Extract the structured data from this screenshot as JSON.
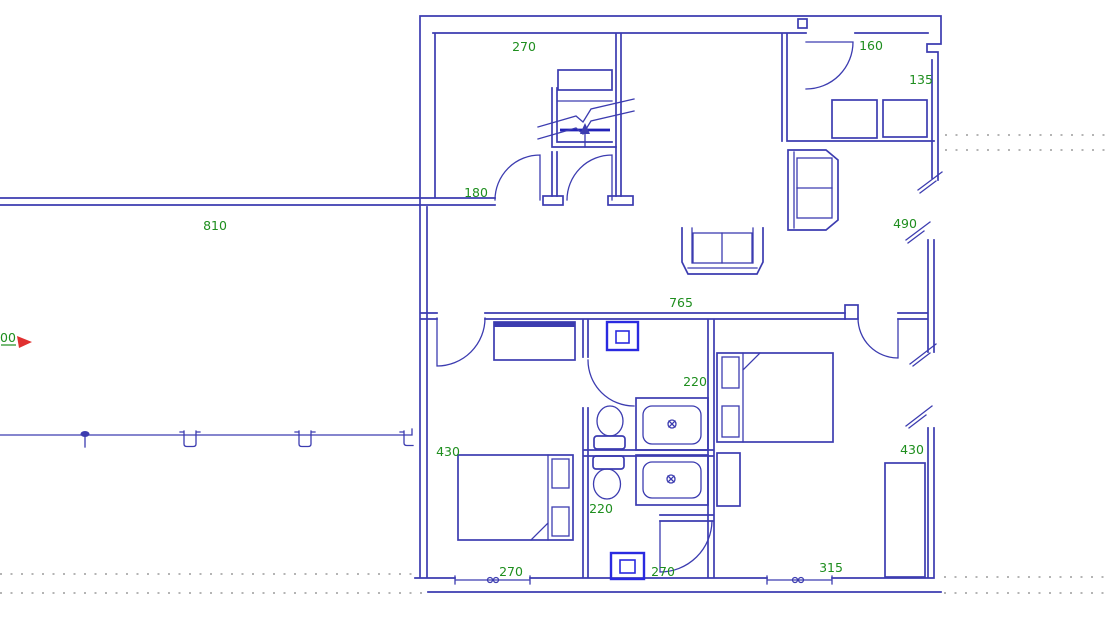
{
  "drawing": {
    "type": "floor-plan",
    "description": "CAD floor plan of an apartment with staircase, living room, two bedrooms, two bathrooms and laundry"
  },
  "colors": {
    "wall": "#3c3cb0",
    "wall_dark": "#2222b8",
    "appliance": "#2a2ae0",
    "dimension": "#1e8e1e",
    "reference": "#9c9c9c",
    "marker_arrow": "#e03030",
    "background": "#ffffff"
  },
  "dimensions": [
    {
      "name": "dim-hall",
      "label": "270",
      "x": 524,
      "y": 51
    },
    {
      "name": "dim-entry-door",
      "label": "160",
      "x": 871,
      "y": 50
    },
    {
      "name": "dim-entry-side",
      "label": "135",
      "x": 921,
      "y": 84
    },
    {
      "name": "dim-hall-door",
      "label": "180",
      "x": 476,
      "y": 197
    },
    {
      "name": "dim-long-wall",
      "label": "810",
      "x": 215,
      "y": 230
    },
    {
      "name": "dim-window-right-upper",
      "label": "490",
      "x": 905,
      "y": 228
    },
    {
      "name": "dim-living-wall",
      "label": "765",
      "x": 681,
      "y": 307
    },
    {
      "name": "dim-bath-upper",
      "label": "220",
      "x": 695,
      "y": 386
    },
    {
      "name": "dim-bedroom-left",
      "label": "430",
      "x": 448,
      "y": 456
    },
    {
      "name": "dim-bath-lower",
      "label": "220",
      "x": 601,
      "y": 513
    },
    {
      "name": "dim-bedroom-right",
      "label": "430",
      "x": 912,
      "y": 454
    },
    {
      "name": "dim-window-bottom-left",
      "label": "270",
      "x": 511,
      "y": 576
    },
    {
      "name": "dim-laundry",
      "label": "270",
      "x": 663,
      "y": 576
    },
    {
      "name": "dim-window-bottom-right",
      "label": "315",
      "x": 831,
      "y": 572
    }
  ],
  "origin_marker": {
    "label": "00"
  },
  "entities": [
    "staircase",
    "stair-up-arrow",
    "door-swing",
    "sofa",
    "armchair",
    "bench-seat",
    "tv-cabinet",
    "double-bed",
    "pillow",
    "nightstand",
    "wardrobe",
    "toilet",
    "sink",
    "washing-machine",
    "window-break",
    "window-sill",
    "fence-post",
    "reference-line"
  ]
}
